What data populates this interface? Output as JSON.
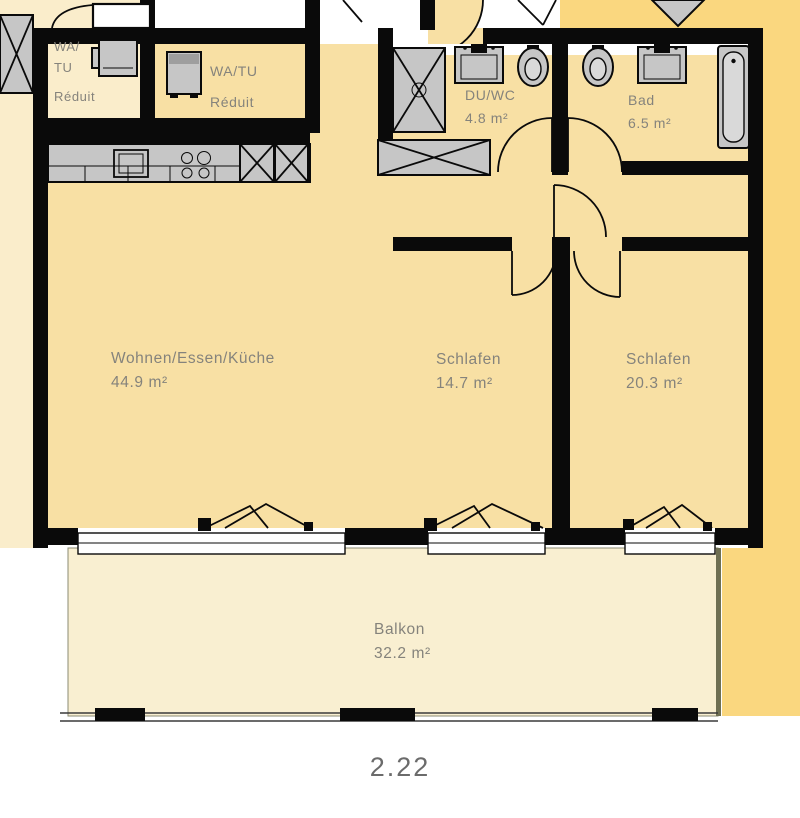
{
  "plan": {
    "unit_number": "2.22",
    "rooms": {
      "reduit_left": {
        "l1": "WA/",
        "l2": "TU",
        "l3": "Réduit"
      },
      "reduit_right": {
        "name": "WA/TU",
        "sub": "Réduit"
      },
      "duwc": {
        "name": "DU/WC",
        "area": "4.8 m²"
      },
      "bad": {
        "name": "Bad",
        "area": "6.5 m²"
      },
      "wohnen": {
        "name": "Wohnen/Essen/Küche",
        "area": "44.9 m²"
      },
      "schlafen_mid": {
        "name": "Schlafen",
        "area": "14.7 m²"
      },
      "schlafen_right": {
        "name": "Schlafen",
        "area": "20.3 m²"
      },
      "balkon": {
        "name": "Balkon",
        "area": "32.2 m²"
      }
    },
    "fixtures": [
      "washer-icon",
      "kitchen-sink-icon",
      "stove-icon",
      "tall-unit-icon",
      "shower-icon",
      "sink-icon",
      "toilet-icon",
      "bathtub-icon",
      "shaft-icon",
      "window-icon",
      "door-swing-icon",
      "stair-arrow-icon",
      "balcony-railing"
    ]
  },
  "colors": {
    "wall_color": "#0a0a0a",
    "room_fill": "#f8e0a4",
    "neighbor_fill": "#faedcb",
    "exterior_fill": "#fad77f",
    "balcony_fill": "#f9efd1",
    "fixture_fill": "#c6c6c6",
    "label_color": "#85837c"
  }
}
